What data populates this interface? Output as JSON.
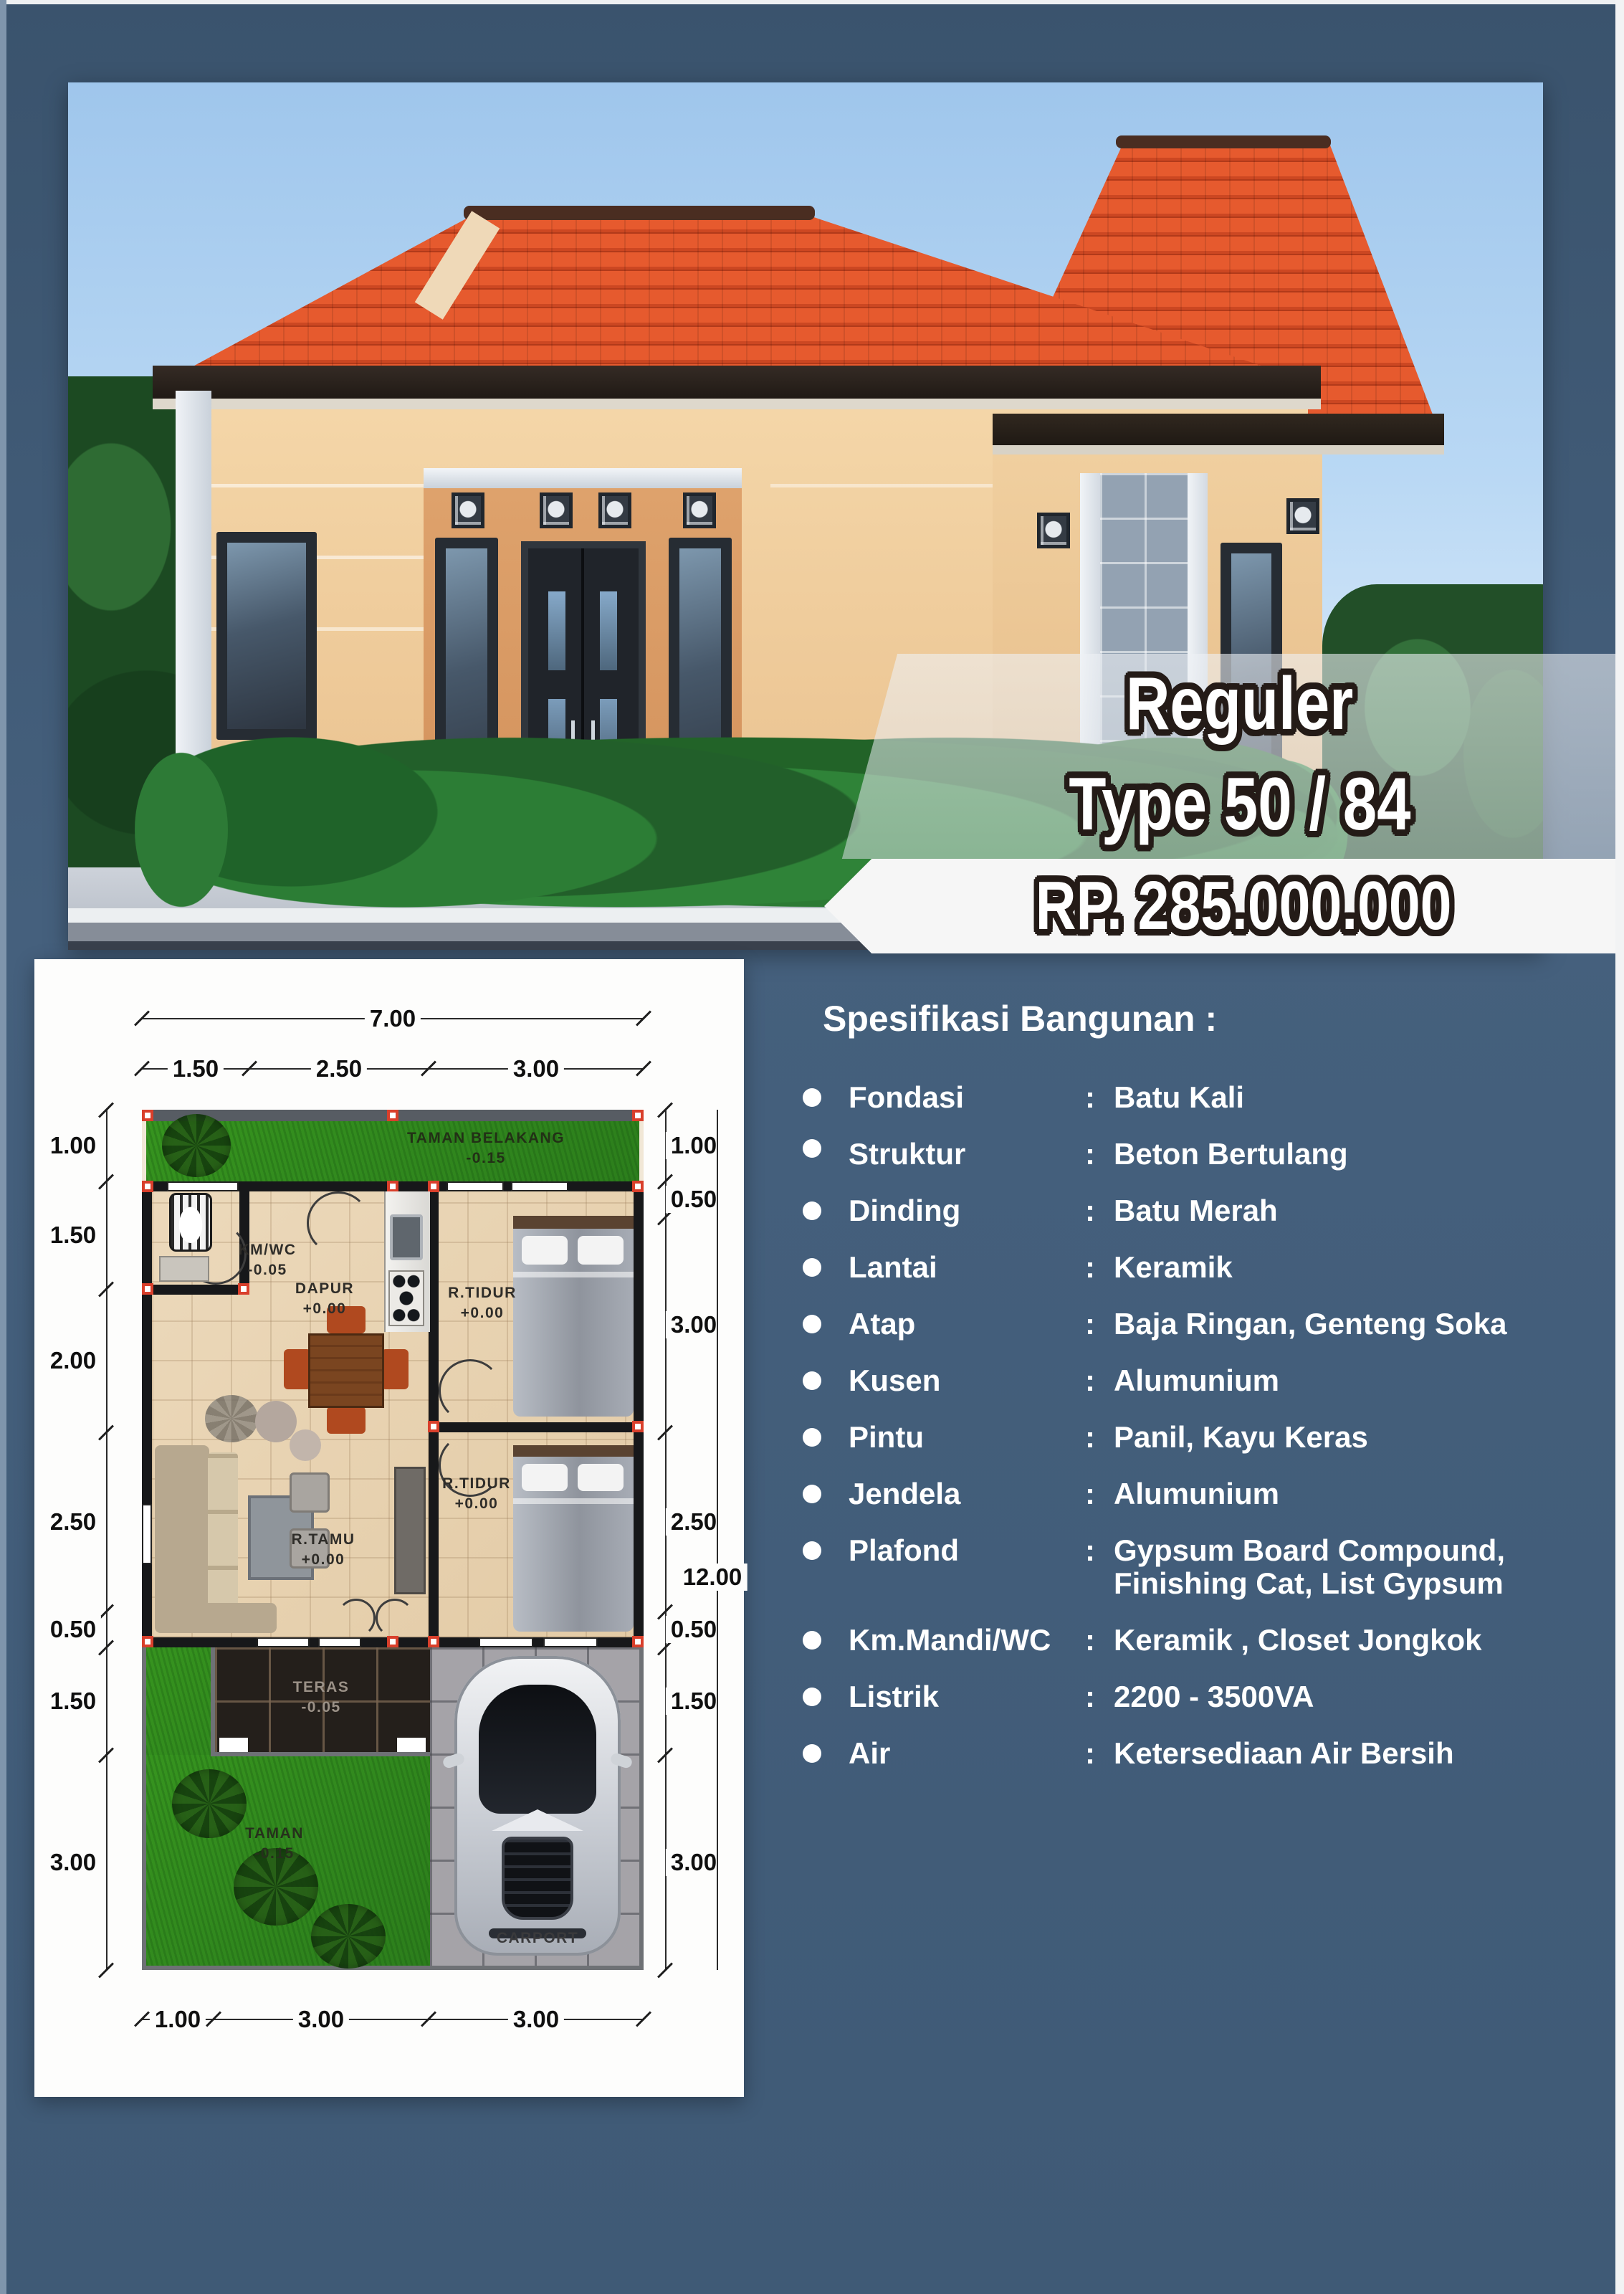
{
  "colors": {
    "page_bg": "#42607d",
    "roof": "#e0512b",
    "wall_cream": "#f2d3a6",
    "grass": "#36941f",
    "price_band": "#f6f6f6",
    "spec_text": "#ffffff"
  },
  "hero": {
    "badge_line1": "Reguler",
    "badge_line2": "Type 50 / 84",
    "price": "RP. 285.000.000"
  },
  "specs": {
    "title": "Spesifikasi Bangunan :",
    "colon": ":",
    "items": [
      {
        "label": "Fondasi",
        "value": "Batu Kali"
      },
      {
        "label": "Struktur",
        "value": "Beton Bertulang"
      },
      {
        "label": "Dinding",
        "value": "Batu Merah"
      },
      {
        "label": "Lantai",
        "value": "Keramik"
      },
      {
        "label": "Atap",
        "value": "Baja Ringan, Genteng Soka"
      },
      {
        "label": "Kusen",
        "value": "Alumunium"
      },
      {
        "label": "Pintu",
        "value": "Panil, Kayu Keras"
      },
      {
        "label": "Jendela",
        "value": "Alumunium"
      },
      {
        "label": "Plafond",
        "value": "Gypsum Board Compound,",
        "value2": "Finishing Cat, List Gypsum"
      },
      {
        "label": "Km.Mandi/WC",
        "value": "Keramik , Closet Jongkok"
      },
      {
        "label": "Listrik",
        "value": "2200 - 3500VA"
      },
      {
        "label": "Air",
        "value": "Ketersediaan Air Bersih"
      }
    ]
  },
  "floorplan": {
    "dim_top_total": "7.00",
    "dim_top_segments": [
      "1.50",
      "2.50",
      "3.00"
    ],
    "dim_left": [
      "1.00",
      "1.50",
      "2.00",
      "2.50",
      "0.50",
      "1.50",
      "3.00"
    ],
    "dim_right": [
      "1.00",
      "0.50",
      "3.00",
      "2.50",
      "0.50",
      "1.50",
      "3.00"
    ],
    "dim_right_total": "12.00",
    "dim_bottom": [
      "1.00",
      "3.00",
      "3.00"
    ],
    "rooms": {
      "taman_belakang": {
        "name": "TAMAN BELAKANG",
        "level": "-0.15"
      },
      "km_wc": {
        "name": "KM/WC",
        "level": "-0.05"
      },
      "dapur": {
        "name": "DAPUR",
        "level": "+0.00"
      },
      "r_tidur_1": {
        "name": "R.TIDUR",
        "level": "+0.00"
      },
      "r_tidur_2": {
        "name": "R.TIDUR",
        "level": "+0.00"
      },
      "r_tamu": {
        "name": "R.TAMU",
        "level": "+0.00"
      },
      "teras": {
        "name": "TERAS",
        "level": "-0.05"
      },
      "taman": {
        "name": "TAMAN",
        "level": "-0.15"
      },
      "carport": {
        "name": "CARPORT"
      }
    }
  }
}
